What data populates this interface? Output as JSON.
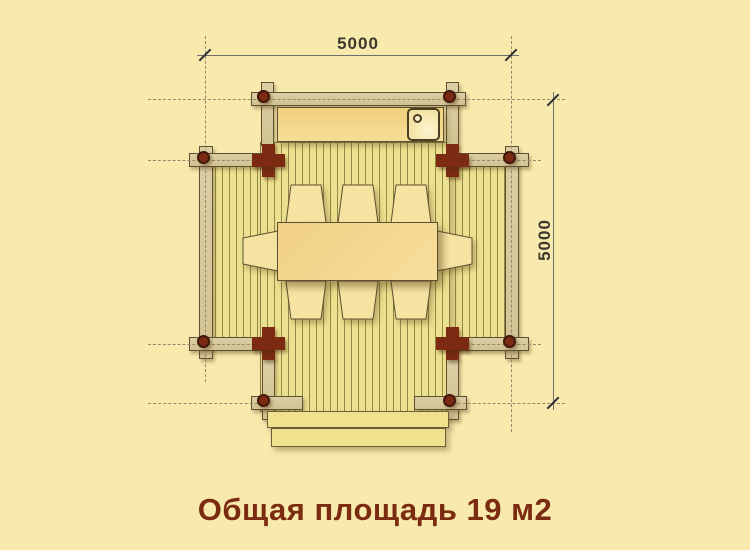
{
  "caption": {
    "text": "Общая площадь 19 м2"
  },
  "dimensions": {
    "top": "5000",
    "right": "5000"
  },
  "colors": {
    "background": "#F8E9AD",
    "beam_wood": "#D8CA9C",
    "log_red": "#7C2B12",
    "floor_plank": "#ECE18F",
    "furniture_wood": "#F3D38A",
    "chair_wood": "#F6E3A2",
    "outline": "#5E5132",
    "caption_text": "#7A2B10",
    "dimension_text": "#3C382E"
  }
}
